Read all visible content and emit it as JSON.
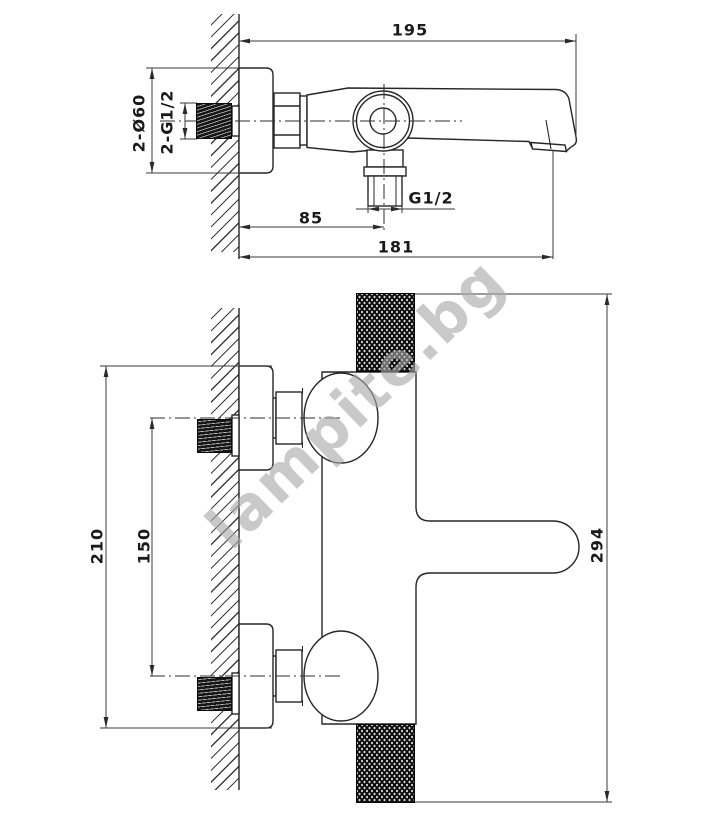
{
  "drawing": {
    "watermark_text": "lampite.bg",
    "side_view": {
      "name": "wall-mounted bath spout side view",
      "dims": {
        "total_projection": {
          "label": "195"
        },
        "outlet_offset": {
          "label": "85"
        },
        "spout_reach": {
          "label": "181"
        },
        "bottom_outlet_thread": {
          "label": "G1/2"
        },
        "escutcheon_diameter": {
          "label": "2-Ø60"
        },
        "inlet_thread": {
          "label": "2-G1/2"
        }
      }
    },
    "front_view": {
      "name": "wall-mounted bath spout front (rotated) view",
      "dims": {
        "escutcheon_outer_span": {
          "label": "210"
        },
        "inlet_spacing": {
          "label": "150"
        },
        "body_length": {
          "label": "294"
        }
      }
    }
  }
}
